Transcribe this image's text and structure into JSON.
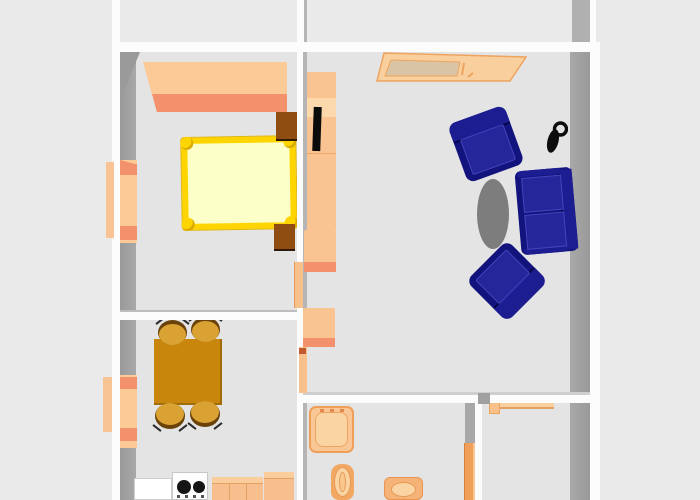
{
  "scene": {
    "type": "3d-floorplan-top-view",
    "description": "Top-down 3D render of an apartment floor plan, no text labels visible",
    "rooms": [
      {
        "name": "bedroom",
        "furniture": [
          "wardrobe",
          "double-bed",
          "nightstand-top",
          "nightstand-bottom",
          "window",
          "door"
        ]
      },
      {
        "name": "living-room",
        "furniture": [
          "wall-unit-with-tv",
          "low-cabinet-1",
          "low-cabinet-2",
          "sideboard-table",
          "armchair-1",
          "armchair-2",
          "sofa",
          "oval-rug",
          "floor-lamp"
        ]
      },
      {
        "name": "dining-room",
        "furniture": [
          "dining-table",
          "chair-1",
          "chair-2",
          "chair-3",
          "chair-4",
          "window",
          "door"
        ]
      },
      {
        "name": "kitchenette",
        "furniture": [
          "white-cabinet",
          "stove-two-burners",
          "counter-1",
          "counter-2"
        ]
      },
      {
        "name": "bathroom",
        "furniture": [
          "shower-tray",
          "toilet",
          "washbasin",
          "door"
        ]
      },
      {
        "name": "entry-room",
        "furniture": [
          "wall-shelf"
        ]
      }
    ]
  },
  "palette": {
    "exterior": "#eaeaea",
    "floor": "#e4e4e5",
    "wallWhite": "#fcfcfc",
    "wallShadow": "#a8a8a8",
    "wallShadowDark": "#9a9a9a",
    "orange": "#f9c491",
    "orangeLight": "#fbd0a0",
    "orangeLighter": "#fcd8ad",
    "salmon": "#f2916c",
    "doorOrange": "#f8c08a",
    "doorDark": "#ef9f58",
    "brown": "#8f4d12",
    "tableBrown": "#c8870c",
    "chairGold": "#d9a233",
    "chairShadow": "#6b4209",
    "bedYellow": "#fed500",
    "mattress": "#fdffc9",
    "navy": "#13137d",
    "navyLight": "#1d1d92",
    "navyCushion": "#26269b",
    "rugGray": "#7d7d7d",
    "black": "#0b0b0b",
    "applianceWhite": "#fdfdfd",
    "counterOrange": "#f7bf8d",
    "counterTop": "#fbcd9d",
    "counterLine": "#e3a265",
    "fixtureBorder": "#ef9f58",
    "fixtureFill": "#f8c795",
    "fixtureInner": "#fbd4a4",
    "sillOrange": "#f8c493",
    "windowFrame": "#fbca97"
  }
}
